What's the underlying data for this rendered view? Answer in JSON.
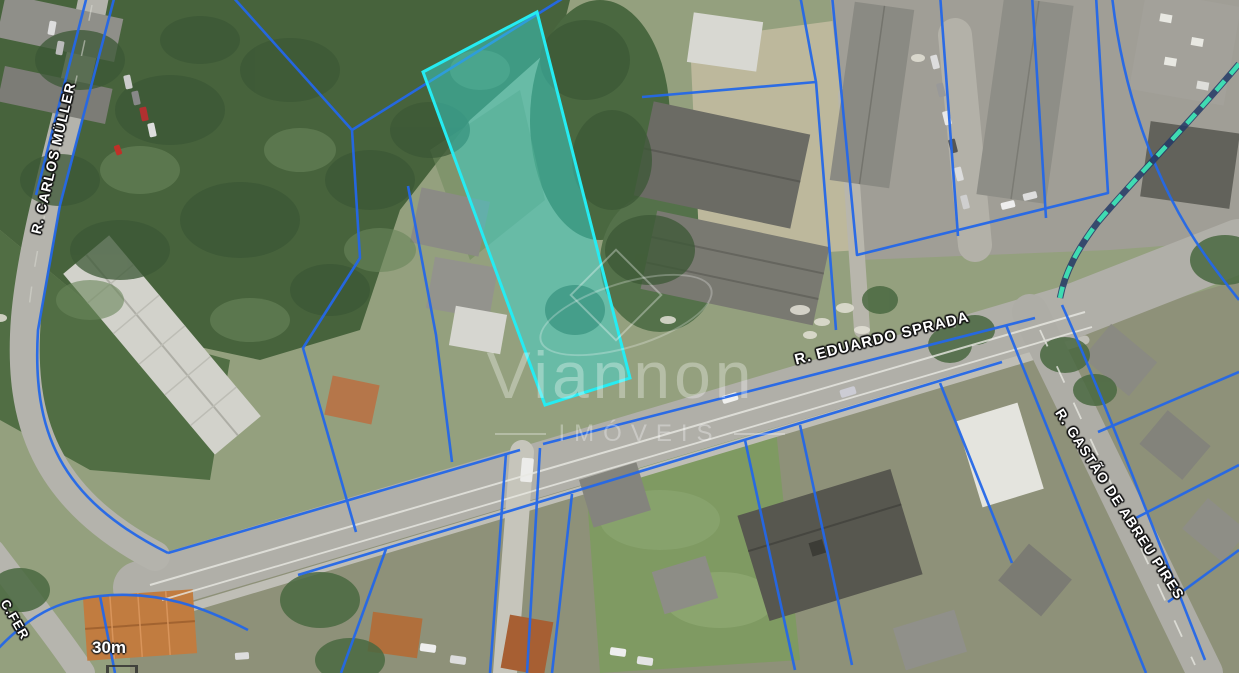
{
  "map": {
    "streets": {
      "carlos_muller": "R. CARLOS MÜLLER",
      "eduardo_sprada": "R. EDUARDO SPRADA",
      "gastao_de_abreu_pires": "R. GASTÃO DE ABREU PIRES",
      "partial_bottom_left": "C.FER"
    },
    "scale": {
      "label": "30m"
    },
    "watermark": {
      "brand": "Viannon",
      "subtitle": "IMÓVEIS"
    },
    "colors": {
      "parcel_boundary_blue": "#2468e8",
      "highlight_parcel_cyan": "#25ecf2",
      "dashed_boundary_teal": "#3fdcb2",
      "road_gray": "#b0afa8",
      "forest_green": "#47633c"
    }
  }
}
